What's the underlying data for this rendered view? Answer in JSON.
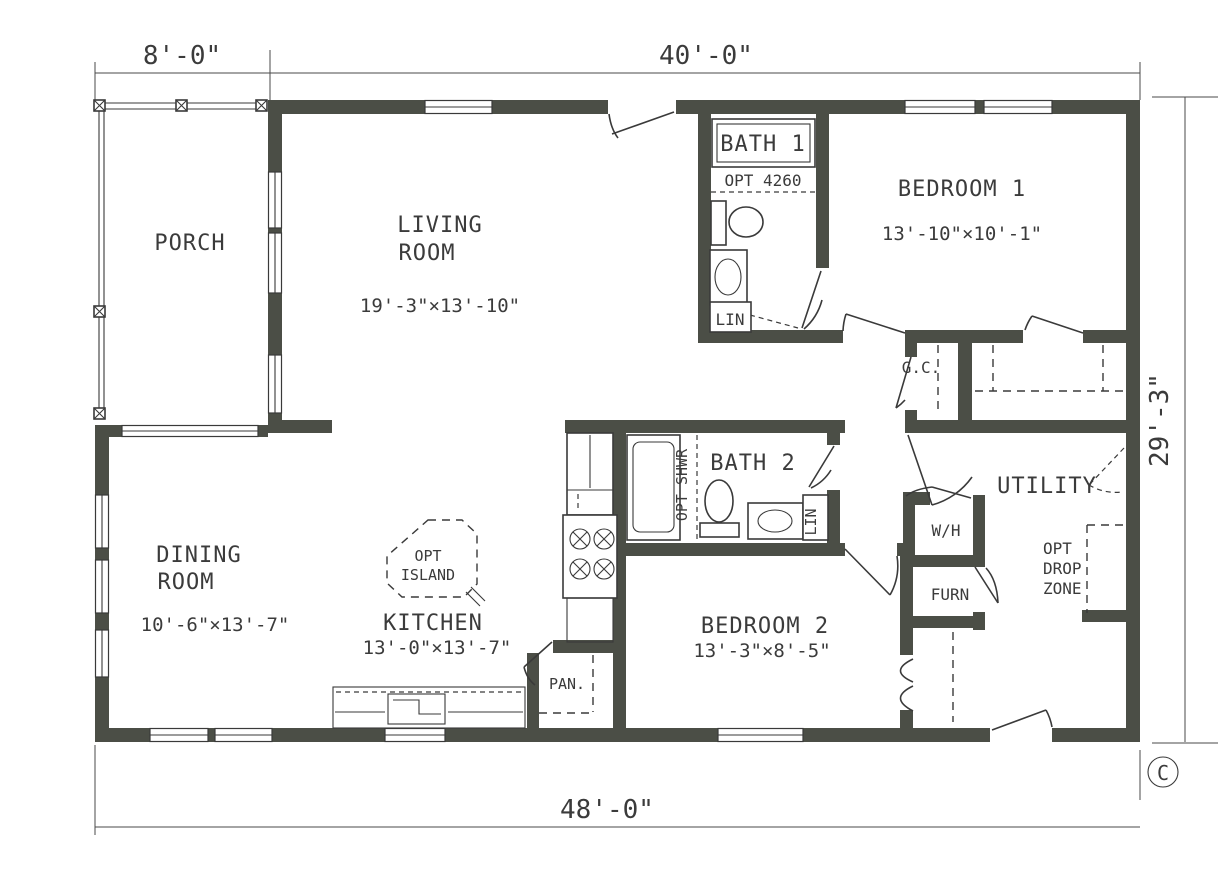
{
  "dimensions": {
    "top_left": "8'-0\"",
    "top_main": "40'-0\"",
    "right_side": "29'-3\"",
    "bottom": "48'-0\""
  },
  "rooms": {
    "porch": {
      "name": "PORCH"
    },
    "living": {
      "name_line1": "LIVING",
      "name_line2": "ROOM",
      "dims": "19'-3\"×13'-10\""
    },
    "bath1": {
      "name": "BATH 1",
      "option": "OPT 4260",
      "linen": "LIN"
    },
    "bedroom1": {
      "name": "BEDROOM 1",
      "dims": "13'-10\"×10'-1\""
    },
    "gc_closet": {
      "name": "G.C."
    },
    "bath2": {
      "name": "BATH 2",
      "opt_shower": "OPT SHWR",
      "linen": "LIN"
    },
    "utility": {
      "name": "UTILITY",
      "water_heater": "W/H",
      "furnace": "FURN",
      "drop_line1": "OPT",
      "drop_line2": "DROP",
      "drop_line3": "ZONE"
    },
    "dining": {
      "name_line1": "DINING",
      "name_line2": "ROOM",
      "dims": "10'-6\"×13'-7\""
    },
    "kitchen": {
      "name": "KITCHEN",
      "dims": "13'-0\"×13'-7\"",
      "island_line1": "OPT",
      "island_line2": "ISLAND",
      "pantry": "PAN."
    },
    "bedroom2": {
      "name": "BEDROOM 2",
      "dims": "13'-3\"×8'-5\""
    }
  },
  "marks": {
    "copyright": "C"
  },
  "colors": {
    "wall": "#4b4e46",
    "line": "#3a3a3a",
    "background": "#ffffff"
  }
}
